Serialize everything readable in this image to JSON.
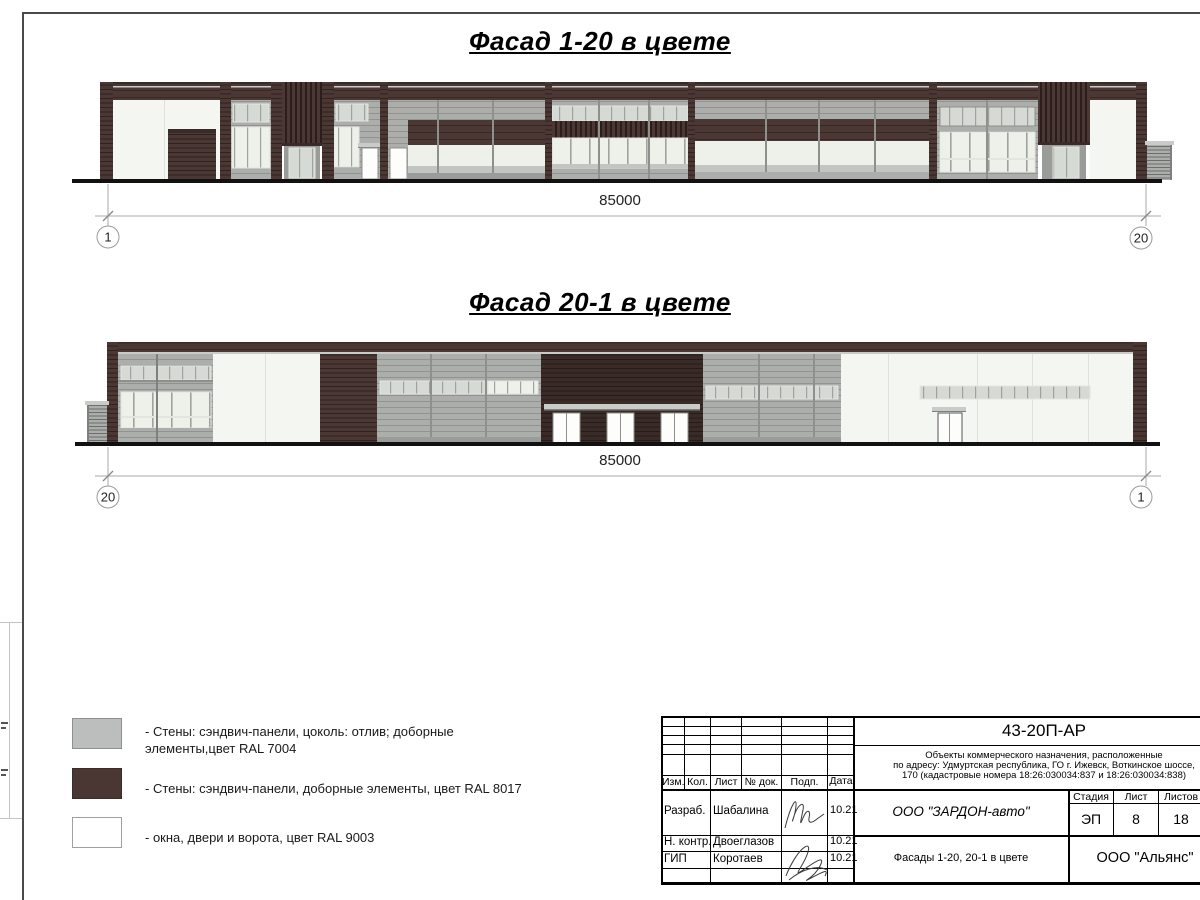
{
  "titles": {
    "facade1": "Фасад 1-20 в цвете",
    "facade2": "Фасад 20-1 в цвете"
  },
  "dimensions": {
    "facade1": {
      "value": "85000",
      "left_axis": "1",
      "right_axis": "20"
    },
    "facade2": {
      "value": "85000",
      "left_axis": "20",
      "right_axis": "1"
    }
  },
  "legend": {
    "items": [
      {
        "color": "#BCBEBD",
        "border": "#8F9190",
        "line1": "- Стены: сэндвич-панели, цоколь: отлив; доборные",
        "line2": "элементы,цвет RAL 7004"
      },
      {
        "color": "#4A3733",
        "border": "#3A2C28",
        "line1": "- Стены: сэндвич-панели, доборные элементы, цвет RAL 8017",
        "line2": ""
      },
      {
        "color": "#FFFFFF",
        "border": "#9FA19E",
        "line1": "- окна, двери и ворота, цвет RAL 9003",
        "line2": ""
      }
    ]
  },
  "title_block": {
    "doc_number": "43-20П-АР",
    "description_line1": "Объекты коммерческого назначения, расположенные",
    "description_line2": "по адресу: Удмуртская республика, ГО г. Ижевск, Воткинское шоссе,",
    "description_line3": "170 (кадастровые номера 18:26:030034:837 и 18:26:030034:838)",
    "rev_headers": {
      "izm": "Изм.",
      "kol": "Кол.",
      "list": "Лист",
      "ndok": "№ док.",
      "podp": "Подп.",
      "data": "Дата"
    },
    "roles": [
      {
        "role": "Разраб.",
        "name": "Шабалина",
        "date": "10.21"
      },
      {
        "role": "Н. контр.",
        "name": "Двоеглазов",
        "date": "10.21"
      },
      {
        "role": "ГИП",
        "name": "Коротаев",
        "date": "10.21"
      }
    ],
    "company": "ООО \"ЗАРДОН-авто\"",
    "sheet_title": "Фасады 1-20, 20-1 в цвете",
    "contractor": "ООО \"Альянс\"",
    "stage_header": "Стадия",
    "sheet_header": "Лист",
    "sheets_header": "Листов",
    "stage": "ЭП",
    "sheet": "8",
    "sheets": "18"
  },
  "palette": {
    "brown": "#4B3834",
    "brownDark": "#392B27",
    "gray": "#ACAEAC",
    "grayLight": "#C9CBC8",
    "grayDark": "#7E807E",
    "grayDark2": "#9A9C99",
    "glassLight": "#EDF1EA",
    "glassMid": "#D6DAD4",
    "glassGray": "#C2C5C1",
    "whiteWall": "#F4F7F1",
    "panelLine": "#DFE1DC",
    "frameGray": "#8E908C",
    "frameLight": "#E3E5E0",
    "doorWhite": "#FDFDFC",
    "doorDark": "#555555",
    "black": "#111111"
  },
  "drawing": {
    "facade1": {
      "rects": [
        [
          100,
          82,
          1047,
          18,
          "brown",
          "hsBrown",
          ""
        ],
        [
          100,
          82,
          1047,
          2,
          "brownDark",
          "",
          ""
        ],
        [
          100,
          86,
          1047,
          1.5,
          "grayLight",
          "",
          ""
        ],
        [
          113,
          100,
          107,
          80,
          "whiteWall",
          "",
          ""
        ],
        [
          164,
          100,
          1,
          80,
          "panelLine",
          "",
          ""
        ],
        [
          168,
          129,
          48,
          51,
          "brown",
          "hsBrownD",
          ""
        ],
        [
          168,
          129,
          48,
          4,
          "brownDark",
          "",
          ""
        ],
        [
          231,
          100,
          40,
          80,
          "gray",
          "hsGray",
          ""
        ],
        [
          233,
          104,
          36,
          18,
          "glassMid",
          "vmSm",
          "frameLight"
        ],
        [
          232,
          127,
          38,
          41,
          "glassLight",
          "vmSm",
          "frameLight"
        ],
        [
          282,
          82,
          40,
          64,
          "brown",
          "vsBrown",
          ""
        ],
        [
          282,
          143,
          40,
          3,
          "brownDark",
          "",
          ""
        ],
        [
          284,
          146,
          36,
          34,
          "grayDark2",
          "",
          ""
        ],
        [
          289,
          148,
          26,
          30,
          "glassMid",
          "vmSm",
          "frameLight"
        ],
        [
          334,
          100,
          46,
          80,
          "gray",
          "hsGray",
          ""
        ],
        [
          336,
          104,
          32,
          17,
          "glassMid",
          "vmSm",
          "frameLight"
        ],
        [
          334,
          127,
          25,
          40,
          "glassLight",
          "vmSm",
          "frameLight"
        ],
        [
          358,
          143,
          54,
          4,
          "grayLight",
          "",
          ""
        ],
        [
          358,
          147,
          54,
          1,
          "grayDark",
          "",
          ""
        ],
        [
          362,
          148,
          16,
          31,
          "doorWhite",
          "",
          "frameGray"
        ],
        [
          388,
          100,
          20,
          80,
          "gray",
          "hsGray",
          ""
        ],
        [
          390,
          148,
          17,
          31,
          "doorWhite",
          "",
          "frameGray"
        ],
        [
          408,
          100,
          137,
          20,
          "gray",
          "hsGray",
          ""
        ],
        [
          408,
          120,
          137,
          25,
          "brown",
          "hsBrown",
          ""
        ],
        [
          408,
          145,
          137,
          27,
          "glassLight",
          "",
          ""
        ],
        [
          408,
          166,
          137,
          7,
          "glassGray",
          "",
          ""
        ],
        [
          408,
          173,
          137,
          7,
          "grayDark2",
          "",
          ""
        ],
        [
          437,
          100,
          2,
          73,
          "frameGray",
          "",
          ""
        ],
        [
          492,
          100,
          2,
          73,
          "frameGray",
          "",
          ""
        ],
        [
          552,
          100,
          136,
          80,
          "gray",
          "hsGray",
          ""
        ],
        [
          552,
          106,
          136,
          15,
          "glassMid",
          "vmSm",
          "frameLight"
        ],
        [
          552,
          121,
          136,
          17,
          "brown",
          "vsBrown",
          ""
        ],
        [
          552,
          138,
          136,
          30,
          "glassLight",
          "vmMd",
          "frameLight"
        ],
        [
          552,
          164,
          136,
          4,
          "glassGray",
          "",
          ""
        ],
        [
          598,
          100,
          2,
          80,
          "frameGray",
          "",
          ""
        ],
        [
          648,
          100,
          2,
          80,
          "frameGray",
          "",
          ""
        ],
        [
          695,
          100,
          234,
          19,
          "gray",
          "hsGray",
          ""
        ],
        [
          695,
          119,
          234,
          22,
          "brown",
          "hsBrown",
          ""
        ],
        [
          695,
          141,
          234,
          31,
          "glassLight",
          "",
          ""
        ],
        [
          695,
          165,
          234,
          7,
          "glassGray",
          "",
          ""
        ],
        [
          695,
          172,
          234,
          8,
          "gray",
          "",
          ""
        ],
        [
          765,
          100,
          2,
          72,
          "frameGray",
          "",
          ""
        ],
        [
          818,
          100,
          2,
          72,
          "frameGray",
          "",
          ""
        ],
        [
          874,
          100,
          2,
          72,
          "frameGray",
          "",
          ""
        ],
        [
          937,
          100,
          101,
          80,
          "gray",
          "hsGray",
          ""
        ],
        [
          940,
          107,
          95,
          19,
          "glassMid",
          "vmSm",
          "frameGray"
        ],
        [
          940,
          132,
          95,
          40,
          "glassLight",
          "vmMd",
          "frameLight"
        ],
        [
          940,
          158,
          95,
          2,
          "frameLight",
          "",
          ""
        ],
        [
          986,
          100,
          2,
          80,
          "frameGray",
          "",
          ""
        ],
        [
          1038,
          82,
          52,
          63,
          "brown",
          "vsBrown",
          ""
        ],
        [
          1038,
          142,
          52,
          3,
          "brownDark",
          "",
          ""
        ],
        [
          1042,
          145,
          44,
          35,
          "grayDark2",
          "",
          ""
        ],
        [
          1053,
          147,
          26,
          31,
          "glassMid",
          "vmSm",
          "frameLight"
        ],
        [
          1090,
          100,
          46,
          80,
          "whiteWall",
          "",
          ""
        ],
        [
          100,
          82,
          13,
          98,
          "brown",
          "hsBrownD",
          ""
        ],
        [
          220,
          82,
          11,
          98,
          "brown",
          "hsBrownD",
          ""
        ],
        [
          271,
          82,
          11,
          98,
          "brown",
          "hsBrownD",
          ""
        ],
        [
          322,
          82,
          12,
          98,
          "brown",
          "hsBrownD",
          ""
        ],
        [
          380,
          82,
          8,
          98,
          "brown",
          "hsBrownD",
          ""
        ],
        [
          545,
          82,
          7,
          98,
          "brown",
          "hsBrownD",
          ""
        ],
        [
          688,
          82,
          7,
          98,
          "brown",
          "hsBrownD",
          ""
        ],
        [
          929,
          82,
          8,
          98,
          "brown",
          "hsBrownD",
          ""
        ],
        [
          1136,
          82,
          11,
          98,
          "brown",
          "hsBrownD",
          ""
        ],
        [
          1145,
          141,
          29,
          4,
          "grayLight",
          "",
          ""
        ],
        [
          1147,
          145,
          25,
          35,
          "gray",
          "hsGrayD",
          ""
        ],
        [
          1170,
          145,
          2,
          35,
          "grayDark",
          "",
          ""
        ],
        [
          72,
          179,
          1090,
          4,
          "black",
          "",
          ""
        ]
      ]
    },
    "facade2": {
      "rects": [
        [
          107,
          342,
          1040,
          12,
          "brown",
          "hsBrown",
          ""
        ],
        [
          107,
          342,
          1040,
          1.5,
          "brownDark",
          "",
          ""
        ],
        [
          107,
          352,
          1040,
          2,
          "grayLight",
          "",
          ""
        ],
        [
          118,
          354,
          95,
          89,
          "gray",
          "hsGray",
          ""
        ],
        [
          121,
          366,
          90,
          14,
          "glassMid",
          "vmSm",
          "frameLight"
        ],
        [
          118,
          380,
          95,
          2,
          "frameGray",
          "",
          ""
        ],
        [
          121,
          392,
          90,
          36,
          "glassLight",
          "vmMd",
          "frameLight"
        ],
        [
          121,
          416,
          90,
          2,
          "frameLight",
          "",
          ""
        ],
        [
          118,
          428,
          95,
          15,
          "gray",
          "hsGray",
          ""
        ],
        [
          156,
          354,
          2,
          89,
          "grayDark",
          "",
          ""
        ],
        [
          213,
          354,
          107,
          89,
          "whiteWall",
          "",
          ""
        ],
        [
          265,
          354,
          1,
          89,
          "panelLine",
          "",
          ""
        ],
        [
          320,
          354,
          57,
          89,
          "brown",
          "hsBrownD",
          ""
        ],
        [
          377,
          354,
          164,
          89,
          "gray",
          "hsGray",
          ""
        ],
        [
          380,
          381,
          158,
          13,
          "glassMid",
          "vmSm",
          "frameLight"
        ],
        [
          488,
          381,
          50,
          13,
          "glassLight",
          "vmSm",
          "frameLight"
        ],
        [
          430,
          354,
          2,
          89,
          "frameGray",
          "",
          ""
        ],
        [
          485,
          354,
          2,
          89,
          "frameGray",
          "",
          ""
        ],
        [
          377,
          437,
          164,
          6,
          "grayDark2",
          "",
          ""
        ],
        [
          541,
          354,
          162,
          89,
          "brownDark",
          "hsBrownD",
          ""
        ],
        [
          544,
          404,
          156,
          5,
          "grayLight",
          "",
          ""
        ],
        [
          544,
          409,
          156,
          1.5,
          "grayDark",
          "",
          ""
        ],
        [
          553,
          413,
          27,
          30,
          "doorWhite",
          "",
          "frameGray"
        ],
        [
          566,
          413,
          1,
          30,
          "frameGray",
          "",
          ""
        ],
        [
          607,
          413,
          27,
          30,
          "doorWhite",
          "",
          "frameGray"
        ],
        [
          620,
          413,
          1,
          30,
          "frameGray",
          "",
          ""
        ],
        [
          661,
          413,
          27,
          30,
          "doorWhite",
          "",
          "frameGray"
        ],
        [
          674,
          413,
          1,
          30,
          "frameGray",
          "",
          ""
        ],
        [
          703,
          354,
          138,
          89,
          "gray",
          "hsGray",
          ""
        ],
        [
          706,
          386,
          132,
          13,
          "glassMid",
          "vmSm",
          "frameLight"
        ],
        [
          758,
          354,
          2,
          89,
          "frameGray",
          "",
          ""
        ],
        [
          813,
          354,
          2,
          89,
          "frameGray",
          "",
          ""
        ],
        [
          703,
          437,
          138,
          6,
          "grayDark2",
          "",
          ""
        ],
        [
          841,
          354,
          292,
          89,
          "whiteWall",
          "",
          ""
        ],
        [
          888,
          354,
          1,
          89,
          "panelLine",
          "",
          ""
        ],
        [
          977,
          354,
          1,
          89,
          "panelLine",
          "",
          ""
        ],
        [
          1032,
          354,
          1,
          89,
          "panelLine",
          "",
          ""
        ],
        [
          1088,
          354,
          1,
          89,
          "panelLine",
          "",
          ""
        ],
        [
          920,
          386,
          170,
          13,
          "glassMid",
          "vmSm",
          "frameLight"
        ],
        [
          932,
          407,
          34,
          4,
          "grayLight",
          "",
          ""
        ],
        [
          932,
          411,
          34,
          1,
          "grayDark",
          "",
          ""
        ],
        [
          938,
          413,
          24,
          30,
          "doorWhite",
          "",
          "doorDark"
        ],
        [
          949,
          413,
          1,
          30,
          "frameGray",
          "",
          ""
        ],
        [
          107,
          342,
          11,
          101,
          "brown",
          "hsBrownD",
          ""
        ],
        [
          1133,
          342,
          14,
          101,
          "brown",
          "hsBrownD",
          ""
        ],
        [
          85,
          401,
          24,
          4,
          "grayLight",
          "",
          ""
        ],
        [
          87,
          405,
          20,
          37,
          "gray",
          "hsGrayD",
          ""
        ],
        [
          87,
          405,
          2,
          37,
          "grayDark",
          "",
          ""
        ],
        [
          75,
          442,
          1085,
          4,
          "black",
          "",
          ""
        ]
      ]
    }
  }
}
